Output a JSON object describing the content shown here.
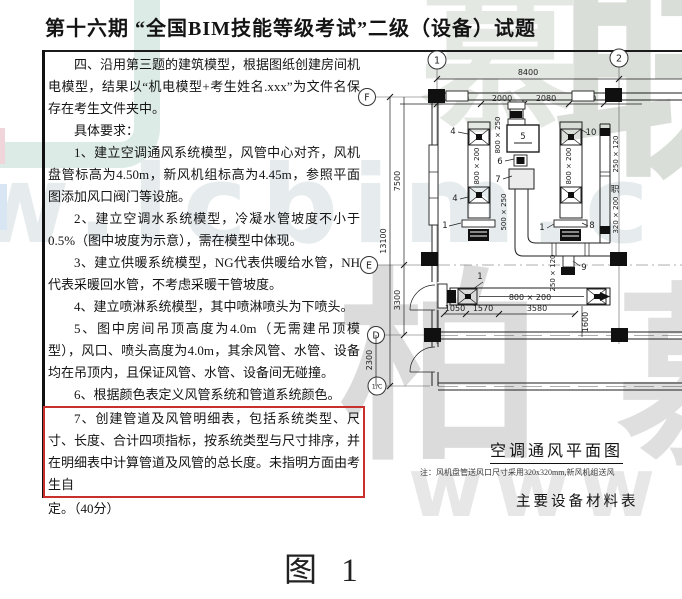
{
  "title": "第十六期 “全国BIM技能等级考试”二级（设备）试题",
  "doc": {
    "p1": "四、沿用第三题的建筑模型，根据图纸创建房间机电模型，结果以“机电模型+考生姓名.xxx”为文件名保存在考生文件夹中。",
    "p2": "具体要求：",
    "p3": "1、建立空调通风系统模型，风管中心对齐，风机盘管标高为4.50m，新风机组标高为4.45m，参照平面图添加风口阀门等设施。",
    "p4": "2、建立空调水系统模型，冷凝水管坡度不小于0.5%（图中坡度为示意），需在模型中体现。",
    "p5": "3、建立供暖系统模型，NG代表供暖给水管，NH代表采暖回水管，不考虑采暖干管坡度。",
    "p6": "4、建立喷淋系统模型，其中喷淋喷头为下喷头。",
    "p7": "5、图中房间吊顶高度为4.0m（无需建吊顶模型），风口、喷头高度为4.0m，其余风管、水管、设备均在吊顶内，且保证风管、水管、设备间无碰撞。",
    "p8": "6、根据颜色表定义风管系统和管道系统颜色。",
    "p9_boxed": "7、创建管道及风管明细表，包括系统类型、尺寸、长度、合计四项指标，按系统类型与尺寸排序，并在明细表中计算管道及风管的总长度。未指明方面由考生自",
    "p9_tail": "定。（40分）"
  },
  "plan": {
    "caption": "空调通风平面图",
    "note": "注：风机盘管送风口尺寸采用320x320mm,新风机组送风",
    "materials_title": "主要设备材料表",
    "bubbles": {
      "g1": "1",
      "g2": "2",
      "gF": "F",
      "gE": "E",
      "gD": "D",
      "gC": "1/C"
    },
    "dims": {
      "d8400": "8400",
      "d2040": "2040",
      "d2000": "2000",
      "d2080": "2080",
      "d1600": "1600",
      "d13100": "13100",
      "d7500": "7500",
      "d3300": "3300",
      "d2300": "2300",
      "d1050": "1050",
      "d1570": "1570",
      "d3580": "3580",
      "d1600v": "1600"
    },
    "ducts": {
      "s800x250": "800 × 250",
      "s500x250": "500 × 250",
      "s800x200": "800 × 200",
      "s250x120": "250 × 120",
      "s320x200": "320 × 200"
    },
    "tags": {
      "t1": "1",
      "t4": "4",
      "t5": "5",
      "t6": "6",
      "t7": "7",
      "t8": "8",
      "t9": "9",
      "t10": "10",
      "room": "职"
    }
  },
  "figure_caption": "图 1",
  "watermark": {
    "brand_top": "联",
    "brand_top2": "慕",
    "brand_mid": "柏",
    "brand_mid2": "慕",
    "url": "w.lcbim.c",
    "www": "www"
  },
  "colors": {
    "highlight_box": "#c9302c",
    "watermark_teal": "#dcebe6",
    "watermark_gray": "#dbdbdb"
  }
}
